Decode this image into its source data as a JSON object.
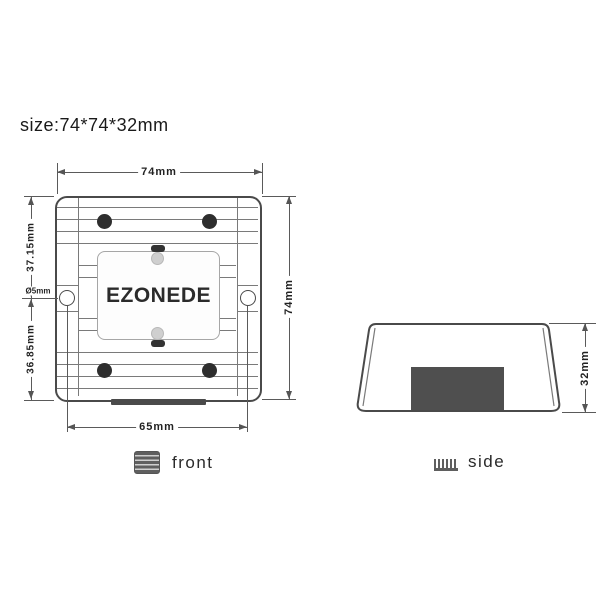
{
  "title": {
    "size_label": "size:74*74*32mm"
  },
  "front_view": {
    "caption": "front",
    "brand_label": "EZONEDE",
    "dimensions": {
      "overall_width": "74mm",
      "overall_height": "74mm",
      "hole_to_top": "37.15mm",
      "hole_to_bottom": "36.85mm",
      "hole_diameter": "Ø5mm",
      "hole_spacing": "65mm"
    }
  },
  "side_view": {
    "caption": "side",
    "dimensions": {
      "overall_depth": "32mm"
    }
  },
  "colors": {
    "background": "#ffffff",
    "outline": "#4a4a4a",
    "fin_line": "#7a7a7a",
    "dimension_line": "#555555",
    "screw": "#2e2e2e",
    "dark_block": "#4f4f4f",
    "label_border": "#a6a6a6"
  }
}
